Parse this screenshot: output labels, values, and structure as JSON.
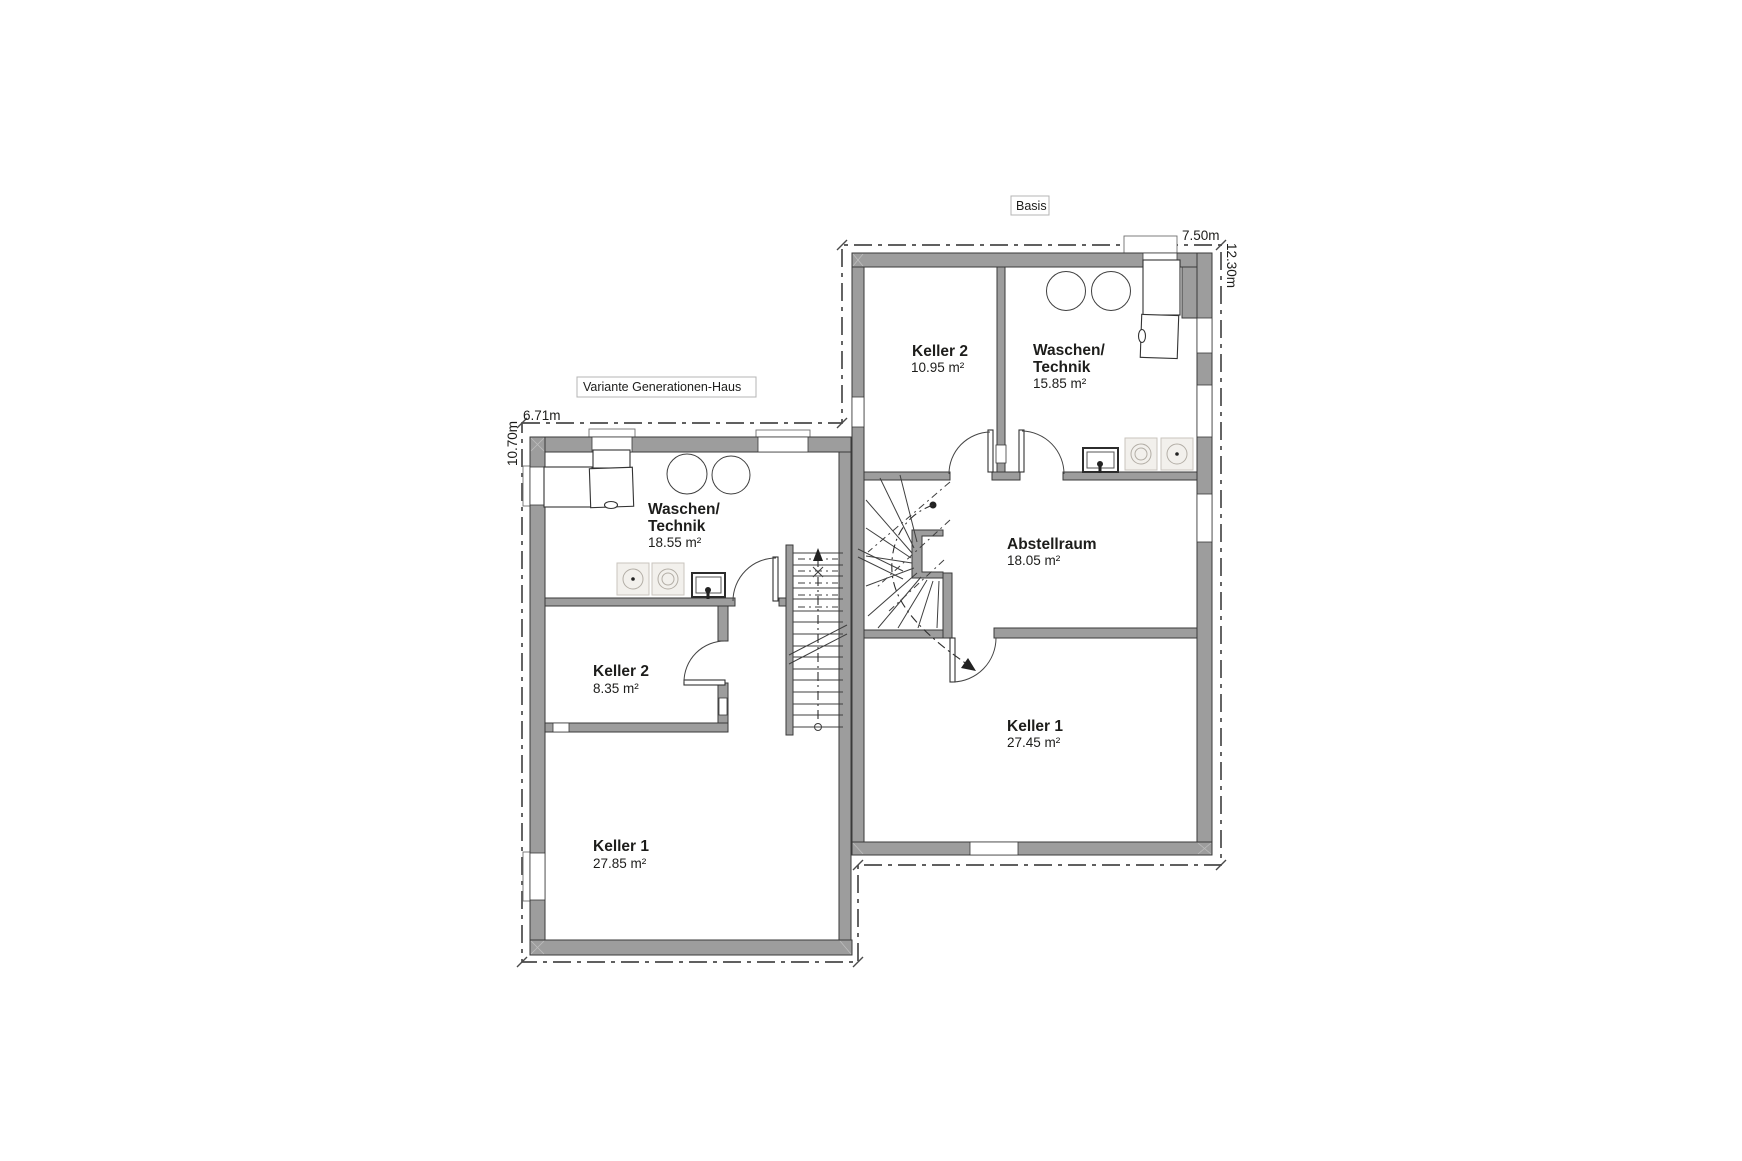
{
  "plan": {
    "title_tags": {
      "basis": "Basis",
      "variante": "Variante Generationen-Haus"
    },
    "dimensions": {
      "basis_width": "7.50m",
      "basis_height": "12.30m",
      "variante_width": "6.71m",
      "variante_height": "10.70m"
    },
    "rooms": {
      "basisKeller2": {
        "name": "Keller 2",
        "area": "10.95 m²"
      },
      "basisWaschen": {
        "name1": "Waschen/",
        "name2": "Technik",
        "area": "15.85 m²"
      },
      "abstellraum": {
        "name": "Abstellraum",
        "area": "18.05 m²"
      },
      "basisKeller1": {
        "name": "Keller 1",
        "area": "27.45 m²"
      },
      "varWaschen": {
        "name1": "Waschen/",
        "name2": "Technik",
        "area": "18.55 m²"
      },
      "varKeller2": {
        "name": "Keller 2",
        "area": "8.35 m²"
      },
      "varKeller1": {
        "name": "Keller 1",
        "area": "27.85 m²"
      }
    },
    "colors": {
      "wall": "#9d9d9d",
      "wall_outline": "#3a3a3a",
      "appliance_fill": "#f2f0ec",
      "line": "#2e2e2e",
      "background": "#ffffff"
    }
  }
}
